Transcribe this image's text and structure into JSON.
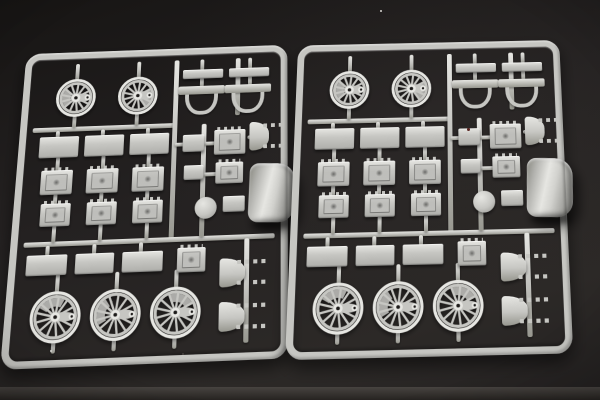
{
  "scene": {
    "type": "photograph",
    "description": "Two light-gray injection-molded plastic model kit sprues with steam locomotive parts - spoked driving wheels, axlebox plates, brackets and a curved shell - lying side by side on a dark textured surface",
    "colors": {
      "background_top": "#171514",
      "background_mid": "#242121",
      "background_bottom": "#2c2927",
      "floor_strip_light": "#474340",
      "floor_strip_dark": "#302d2a",
      "plastic": "#c6c6c2",
      "plastic_highlight": "#e6e6e2",
      "plastic_shadow": "#97978f",
      "hole_dark": "#1d1b1a",
      "dust_speck": "#d8d8d4",
      "red_speck": "#5a2420"
    }
  },
  "sprues": [
    {
      "name": "sprue-left",
      "x": 14,
      "y": 40,
      "w": 274,
      "h": 318,
      "transform": "perspective(560px) rotateX(10deg) rotateZ(-2.2deg) skewX(-4.5deg)"
    },
    {
      "name": "sprue-right",
      "x": 292,
      "y": 33,
      "w": 274,
      "h": 318,
      "transform": "perspective(560px) rotateX(10deg) rotateZ(-1.3deg) skewX(-1.2deg)"
    }
  ],
  "sprue_layout": {
    "frame_border_px": 7,
    "corner_radius_px": 16,
    "wheel_spokes": 13,
    "part_counts_per_sprue": {
      "small_spoked_wheels": 2,
      "large_spoked_wheels": 3,
      "detailed_axlebox_plates": 9,
      "flat_plates": 11,
      "u_brackets": 2,
      "studded_arc_brackets": 3,
      "round_cover": 1,
      "curved_shell": 1,
      "runner_bars_and_stubs": 40
    },
    "parts": [
      {
        "t": "bar",
        "x": 6,
        "y": 74,
        "w": 146,
        "h": 5
      },
      {
        "t": "bar",
        "x": 149,
        "y": 6,
        "w": 5,
        "h": 188
      },
      {
        "t": "bar",
        "x": 6,
        "y": 191,
        "w": 248,
        "h": 5
      },
      {
        "t": "bar",
        "x": 179,
        "y": 76,
        "w": 5,
        "h": 116
      },
      {
        "t": "bar",
        "x": 213,
        "y": 6,
        "w": 5,
        "h": 62
      },
      {
        "t": "bar",
        "x": 224,
        "y": 195,
        "w": 5,
        "h": 100
      },
      {
        "t": "bar",
        "x": 46,
        "y": 6,
        "w": 4,
        "h": 19
      },
      {
        "t": "bar",
        "x": 110,
        "y": 6,
        "w": 4,
        "h": 19
      },
      {
        "t": "bar",
        "x": 46,
        "y": 61,
        "w": 4,
        "h": 14
      },
      {
        "t": "bar",
        "x": 110,
        "y": 61,
        "w": 4,
        "h": 14
      },
      {
        "t": "bar",
        "x": 30,
        "y": 78,
        "w": 4,
        "h": 7
      },
      {
        "t": "bar",
        "x": 76,
        "y": 78,
        "w": 4,
        "h": 7
      },
      {
        "t": "bar",
        "x": 122,
        "y": 78,
        "w": 4,
        "h": 7
      },
      {
        "t": "bar",
        "x": 32,
        "y": 105,
        "w": 4,
        "h": 15
      },
      {
        "t": "bar",
        "x": 78,
        "y": 105,
        "w": 4,
        "h": 15
      },
      {
        "t": "bar",
        "x": 124,
        "y": 105,
        "w": 4,
        "h": 15
      },
      {
        "t": "bar",
        "x": 32,
        "y": 143,
        "w": 4,
        "h": 11
      },
      {
        "t": "bar",
        "x": 78,
        "y": 143,
        "w": 4,
        "h": 11
      },
      {
        "t": "bar",
        "x": 124,
        "y": 143,
        "w": 4,
        "h": 11
      },
      {
        "t": "bar",
        "x": 33,
        "y": 175,
        "w": 4,
        "h": 17
      },
      {
        "t": "bar",
        "x": 79,
        "y": 175,
        "w": 4,
        "h": 17
      },
      {
        "t": "bar",
        "x": 125,
        "y": 175,
        "w": 4,
        "h": 17
      },
      {
        "t": "bar",
        "x": 28,
        "y": 195,
        "w": 4,
        "h": 10
      },
      {
        "t": "bar",
        "x": 74,
        "y": 195,
        "w": 4,
        "h": 10
      },
      {
        "t": "bar",
        "x": 120,
        "y": 195,
        "w": 4,
        "h": 10
      },
      {
        "t": "bar",
        "x": 40,
        "y": 223,
        "w": 4,
        "h": 20
      },
      {
        "t": "bar",
        "x": 98,
        "y": 223,
        "w": 4,
        "h": 20
      },
      {
        "t": "bar",
        "x": 156,
        "y": 223,
        "w": 4,
        "h": 20
      },
      {
        "t": "bar",
        "x": 40,
        "y": 286,
        "w": 4,
        "h": 12
      },
      {
        "t": "bar",
        "x": 98,
        "y": 286,
        "w": 4,
        "h": 12
      },
      {
        "t": "bar",
        "x": 156,
        "y": 286,
        "w": 4,
        "h": 12
      },
      {
        "t": "bar",
        "x": 176,
        "y": 6,
        "w": 4,
        "h": 12
      },
      {
        "t": "bar",
        "x": 226,
        "y": 6,
        "w": 4,
        "h": 12
      },
      {
        "t": "bar",
        "x": 176,
        "y": 26,
        "w": 4,
        "h": 10
      },
      {
        "t": "bar",
        "x": 226,
        "y": 26,
        "w": 4,
        "h": 10
      },
      {
        "t": "bar",
        "x": 152,
        "y": 95,
        "w": 10,
        "h": 4
      },
      {
        "t": "bar",
        "x": 182,
        "y": 95,
        "w": 12,
        "h": 4
      },
      {
        "t": "bar",
        "x": 182,
        "y": 127,
        "w": 14,
        "h": 4
      },
      {
        "t": "bar",
        "x": 182,
        "y": 161,
        "w": 10,
        "h": 4
      },
      {
        "t": "bar",
        "x": 226,
        "y": 90,
        "w": 8,
        "h": 4
      },
      {
        "t": "wheelS",
        "cx": 48,
        "cy": 43,
        "r": 19,
        "wa": 140
      },
      {
        "t": "wheelS",
        "cx": 112,
        "cy": 43,
        "r": 19,
        "wa": -30
      },
      {
        "t": "rect",
        "x": 158,
        "y": 17,
        "w": 42,
        "h": 10
      },
      {
        "t": "rect",
        "x": 206,
        "y": 17,
        "w": 42,
        "h": 10
      },
      {
        "t": "bracket",
        "x": 157,
        "y": 35,
        "w": 42,
        "h": 31
      },
      {
        "t": "bracket",
        "x": 205,
        "y": 35,
        "w": 42,
        "h": 31
      },
      {
        "t": "rect",
        "x": 14,
        "y": 84,
        "w": 40,
        "h": 22
      },
      {
        "t": "rect",
        "x": 60,
        "y": 84,
        "w": 40,
        "h": 22
      },
      {
        "t": "rect",
        "x": 106,
        "y": 84,
        "w": 40,
        "h": 22
      },
      {
        "t": "rectd",
        "x": 18,
        "y": 119,
        "w": 32,
        "h": 25
      },
      {
        "t": "rectd",
        "x": 64,
        "y": 119,
        "w": 32,
        "h": 25
      },
      {
        "t": "rectd",
        "x": 110,
        "y": 119,
        "w": 32,
        "h": 25
      },
      {
        "t": "rectd",
        "x": 20,
        "y": 153,
        "w": 30,
        "h": 23
      },
      {
        "t": "rectd",
        "x": 66,
        "y": 153,
        "w": 30,
        "h": 23
      },
      {
        "t": "rectd",
        "x": 112,
        "y": 153,
        "w": 30,
        "h": 23
      },
      {
        "t": "rect",
        "x": 10,
        "y": 204,
        "w": 40,
        "h": 20
      },
      {
        "t": "rect",
        "x": 58,
        "y": 204,
        "w": 38,
        "h": 20
      },
      {
        "t": "rect",
        "x": 104,
        "y": 204,
        "w": 40,
        "h": 20
      },
      {
        "t": "rectd",
        "x": 158,
        "y": 202,
        "w": 28,
        "h": 24
      },
      {
        "t": "rect",
        "x": 160,
        "y": 87,
        "w": 22,
        "h": 18
      },
      {
        "t": "rectd",
        "x": 192,
        "y": 83,
        "w": 32,
        "h": 26
      },
      {
        "t": "rect",
        "x": 162,
        "y": 119,
        "w": 20,
        "h": 15
      },
      {
        "t": "rectd",
        "x": 194,
        "y": 117,
        "w": 28,
        "h": 22
      },
      {
        "t": "circle",
        "cx": 185,
        "cy": 163,
        "r": 11
      },
      {
        "t": "rect",
        "x": 202,
        "y": 152,
        "w": 22,
        "h": 16
      },
      {
        "t": "spring",
        "x": 228,
        "y": 76,
        "w": 36,
        "h": 30
      },
      {
        "t": "shell",
        "x": 228,
        "y": 120,
        "w": 46,
        "h": 60
      },
      {
        "t": "wheelL",
        "cx": 42,
        "cy": 264,
        "r": 23,
        "wa": 210
      },
      {
        "t": "wheelL",
        "cx": 100,
        "cy": 264,
        "r": 23,
        "wa": 150
      },
      {
        "t": "wheelL",
        "cx": 158,
        "cy": 264,
        "r": 23,
        "wa": 250
      },
      {
        "t": "spring",
        "x": 200,
        "y": 214,
        "w": 46,
        "h": 28
      },
      {
        "t": "spring",
        "x": 200,
        "y": 256,
        "w": 46,
        "h": 28
      }
    ]
  },
  "specks": [
    {
      "x": 380,
      "y": 10,
      "s": 2,
      "c": "dust_speck"
    },
    {
      "x": 467,
      "y": 128,
      "s": 3,
      "c": "red_speck"
    },
    {
      "x": 50,
      "y": 350,
      "s": 2,
      "c": "dust_speck"
    },
    {
      "x": 182,
      "y": 353,
      "s": 2,
      "c": "floor_strip_light"
    }
  ]
}
